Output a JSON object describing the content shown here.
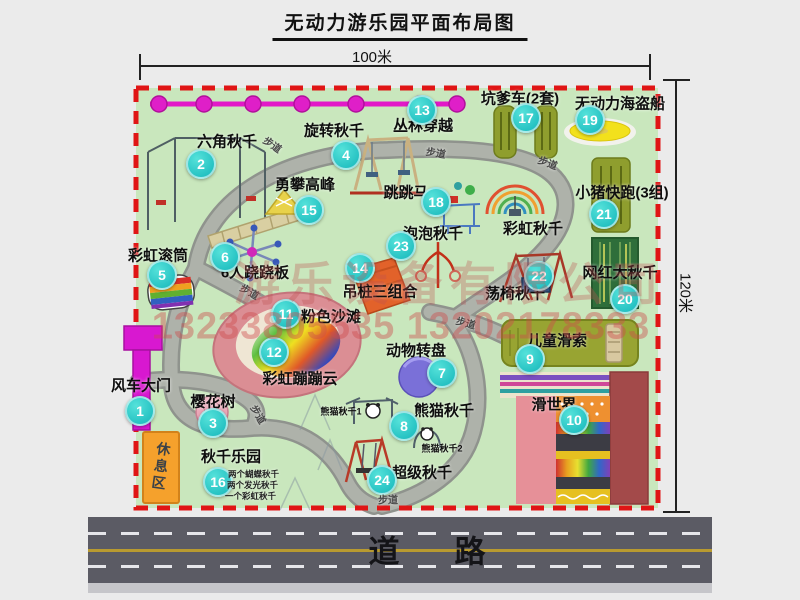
{
  "title": "无动力游乐园平面布局图",
  "dimensions": {
    "width": "100米",
    "height": "120米"
  },
  "road": {
    "label": "道　路"
  },
  "path_label": "步道",
  "rest_area": "休息区",
  "watermark": {
    "company": "游乐设备有限公司",
    "phones": "13233805535 13202178333"
  },
  "extra_labels": {
    "rainbow_swing": "彩虹秋千"
  },
  "sub_labels": [
    "熊猫秋千1",
    "熊猫秋千2"
  ],
  "attractions": [
    {
      "num": "1",
      "label": "风车大门"
    },
    {
      "num": "2",
      "label": "六角秋千"
    },
    {
      "num": "3",
      "label": "樱花树"
    },
    {
      "num": "4",
      "label": "旋转秋千"
    },
    {
      "num": "5",
      "label": "彩虹滚筒"
    },
    {
      "num": "6",
      "label": "6人跷跷板"
    },
    {
      "num": "7",
      "label": "动物转盘"
    },
    {
      "num": "8",
      "label": "熊猫秋千"
    },
    {
      "num": "9",
      "label": "儿童滑索"
    },
    {
      "num": "10",
      "label": "滑世界"
    },
    {
      "num": "11",
      "label": "粉色沙滩"
    },
    {
      "num": "12",
      "label": "彩虹蹦蹦云"
    },
    {
      "num": "13",
      "label": "丛林穿越"
    },
    {
      "num": "14",
      "label": "吊桩三组合"
    },
    {
      "num": "15",
      "label": "勇攀高峰"
    },
    {
      "num": "16",
      "label": "秋千乐园",
      "notes": [
        "两个蝴蝶秋千",
        "两个发光秋千",
        "一个彩虹秋千"
      ]
    },
    {
      "num": "17",
      "label": "坑爹车(2套)"
    },
    {
      "num": "18",
      "label": "跳跳马"
    },
    {
      "num": "19",
      "label": "无动力海盗船"
    },
    {
      "num": "20",
      "label": "网红大秋千"
    },
    {
      "num": "21",
      "label": "小猪快跑(3组)"
    },
    {
      "num": "22",
      "label": "荡椅秋千"
    },
    {
      "num": "23",
      "label": "泡泡秋千"
    },
    {
      "num": "24",
      "label": "超级秋千"
    }
  ],
  "colors": {
    "park_green": "#c9e7bd",
    "border_red": "#e01515",
    "marker_teal": "#14b6ba",
    "bead_magenta": "#e218c8",
    "road_gray": "#5b5b64",
    "rest_area_orange": "#f5a12c"
  }
}
